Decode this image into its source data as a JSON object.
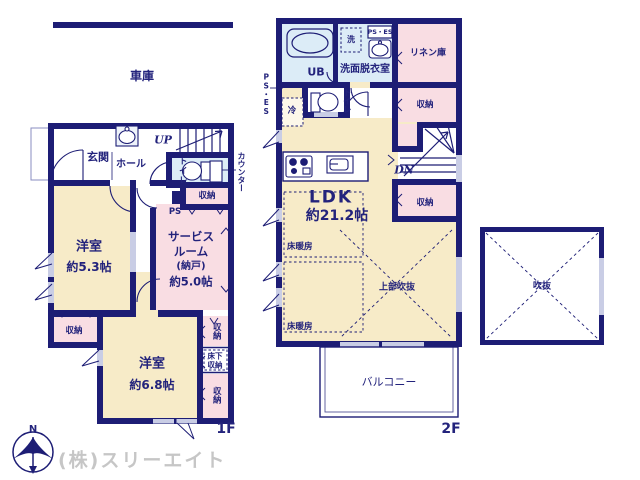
{
  "colors": {
    "wall_navy": "#1d1d75",
    "text_navy": "#23237c",
    "room_cream": "#f7ebc8",
    "room_pink": "#f9dde3",
    "room_blue": "#dcecf7",
    "window_gray": "#c9cde5",
    "company_gray": "#c6c6c6"
  },
  "f1": {
    "floor_label": "1F",
    "garage": "車庫",
    "entrance": "玄関",
    "hall": "ホール",
    "up": "UP",
    "toilet": "トイレ",
    "counter": "カウンター",
    "storage_by_toilet": "収納",
    "ps": "PS",
    "room53": {
      "name": "洋室",
      "size": "約5.3帖"
    },
    "service": {
      "l1": "サービス",
      "l2": "ルーム",
      "l3": "(納戸)",
      "l4": "約5.0帖"
    },
    "room68": {
      "name": "洋室",
      "size": "約6.8帖"
    },
    "storage_bl": "収納",
    "storage_r1": "収納",
    "underfloor_l1": "床下",
    "underfloor_l2": "収納",
    "storage_r2": "収納"
  },
  "f2": {
    "floor_label": "2F",
    "ub": "UB",
    "washer": "洗",
    "ps_es_box": "PS・ES",
    "ps_es_side": "PS・ES",
    "linen": "リネン庫",
    "washroom": "洗面脱衣室",
    "fridge": "冷",
    "toilet": "トイレ",
    "storage_top": "収納",
    "dn": "DN",
    "storage_mid": "収納",
    "ldk": {
      "name": "LDK",
      "size": "約21.2帖"
    },
    "floor_heating": "床暖房",
    "floor_heating2": "床暖房",
    "upper_void": "上部吹抜",
    "balcony": "バルコニー"
  },
  "void_label": "吹抜",
  "compass_n": "N",
  "company": "(株)スリーエイト"
}
